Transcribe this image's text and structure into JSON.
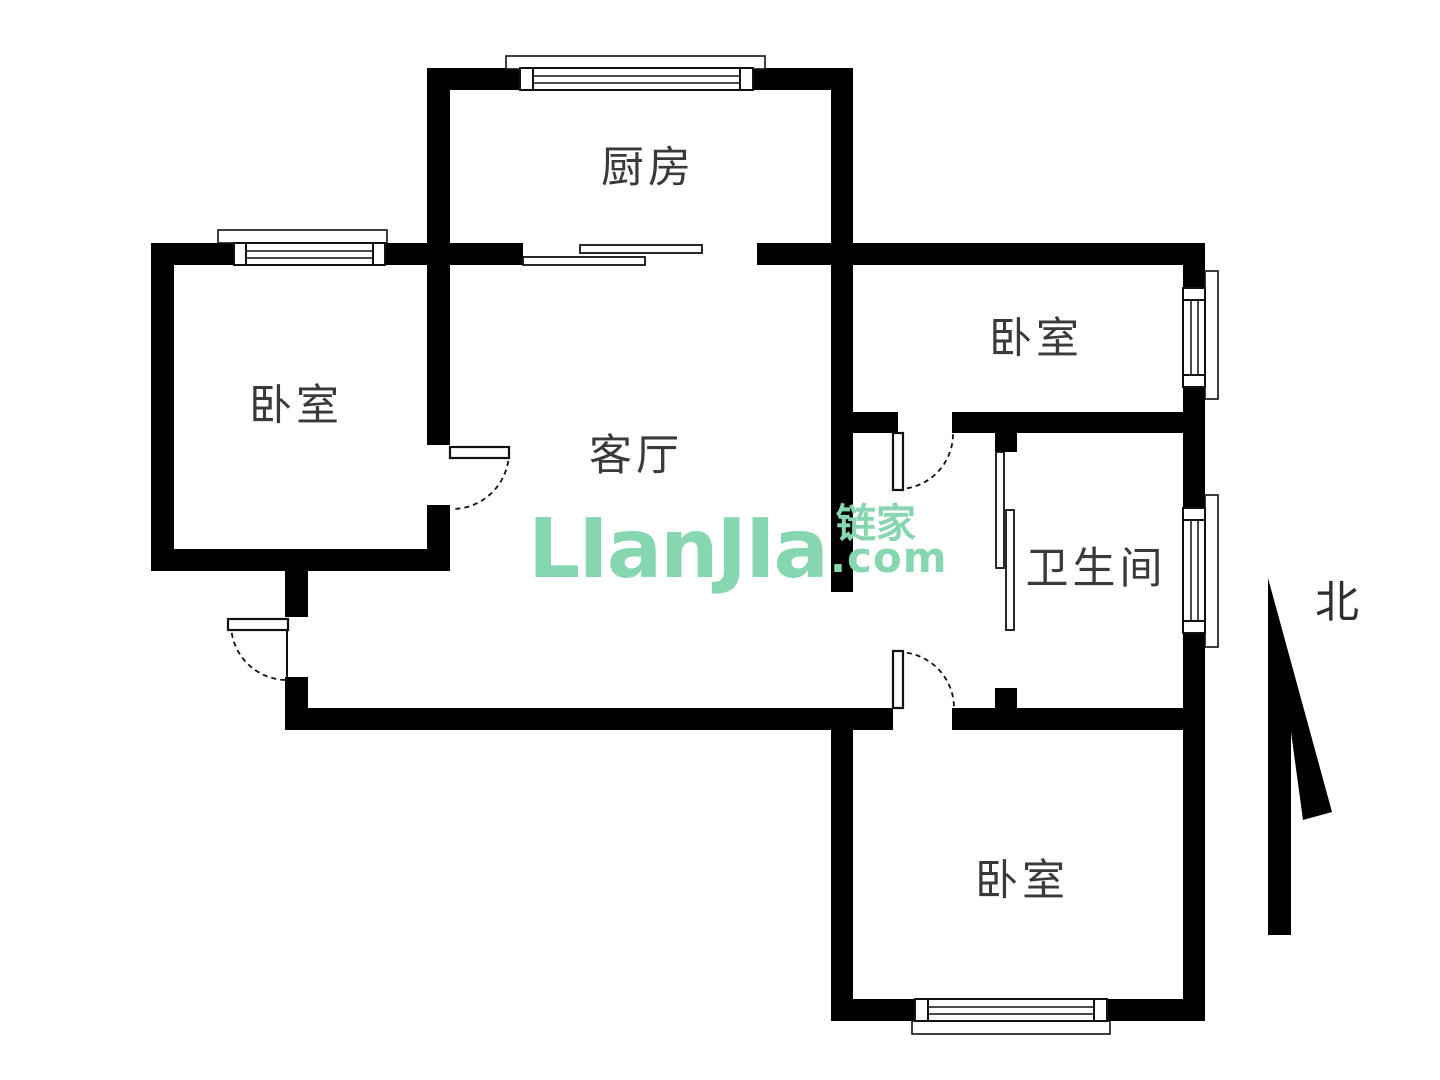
{
  "rooms": {
    "kitchen": {
      "label": "厨房"
    },
    "bedroom_left": {
      "label": "卧室"
    },
    "living_room": {
      "label": "客厅"
    },
    "bedroom_top_right": {
      "label": "卧室"
    },
    "bathroom": {
      "label": "卫生间"
    },
    "bedroom_bottom": {
      "label": "卧室"
    }
  },
  "watermark": {
    "brand": "LIanJIa",
    "cjk": "链家",
    "tld": ".com"
  },
  "compass": {
    "north_label": "北"
  },
  "colors": {
    "wall": "#000000",
    "line": "#111111",
    "label": "#3a3a3a",
    "background": "#ffffff",
    "wm": "#86d6b0"
  }
}
